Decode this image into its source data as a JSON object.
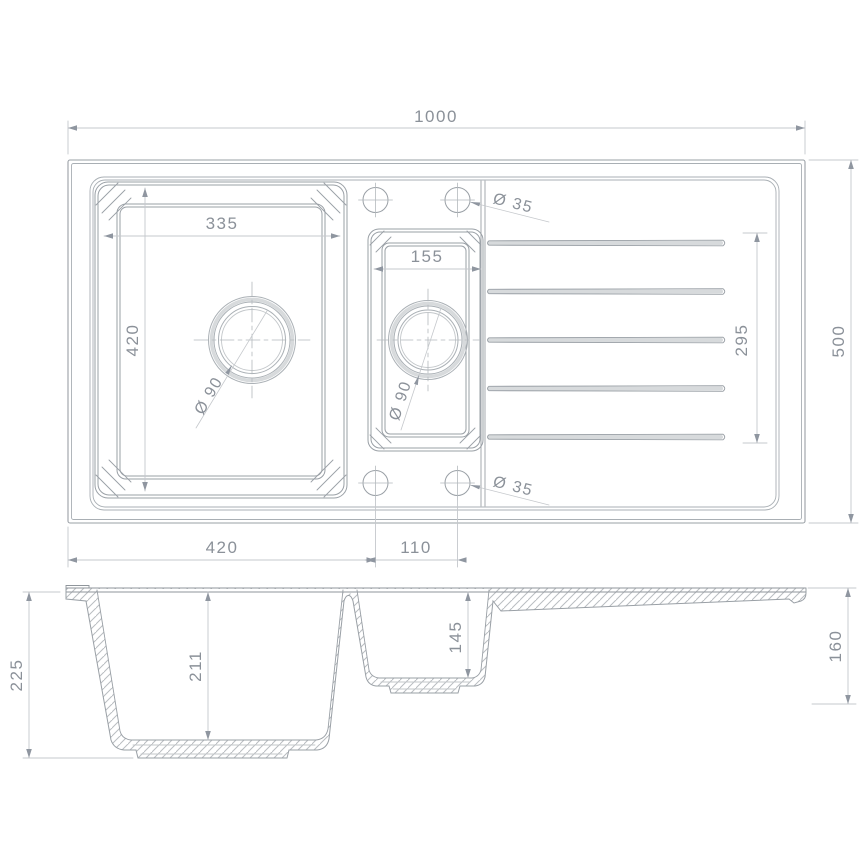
{
  "drawing": {
    "kind": "technical-drawing",
    "subject": "1.5 bowl kitchen sink with drainer",
    "views": [
      "plan-view",
      "section-view"
    ]
  },
  "colors": {
    "background": "#ffffff",
    "object_line": "#9aa0a6",
    "secondary_line": "#a9afb4",
    "faint_line": "#c3c7ca",
    "dim_line": "#c5c8cc",
    "hatch": "#b9bdc1",
    "shade_band": "#d7dadc",
    "text": "#8b9199"
  },
  "top_view": {
    "dimensions": {
      "overall_width": "1000",
      "overall_depth": "500",
      "main_bowl_width": "335",
      "main_bowl_length": "420",
      "small_bowl_width": "155",
      "drainer_length": "295",
      "tap_hole_top": "Ø 35",
      "tap_hole_bottom": "Ø 35",
      "main_bowl_drain": "Ø 90",
      "small_bowl_drain": "Ø 90",
      "main_bowl_offset": "420",
      "bowl_spacing": "110"
    }
  },
  "side_view": {
    "dimensions": {
      "overall_height": "225",
      "main_bowl_depth": "211",
      "small_bowl_depth": "145",
      "drainer_end_height": "160"
    }
  }
}
